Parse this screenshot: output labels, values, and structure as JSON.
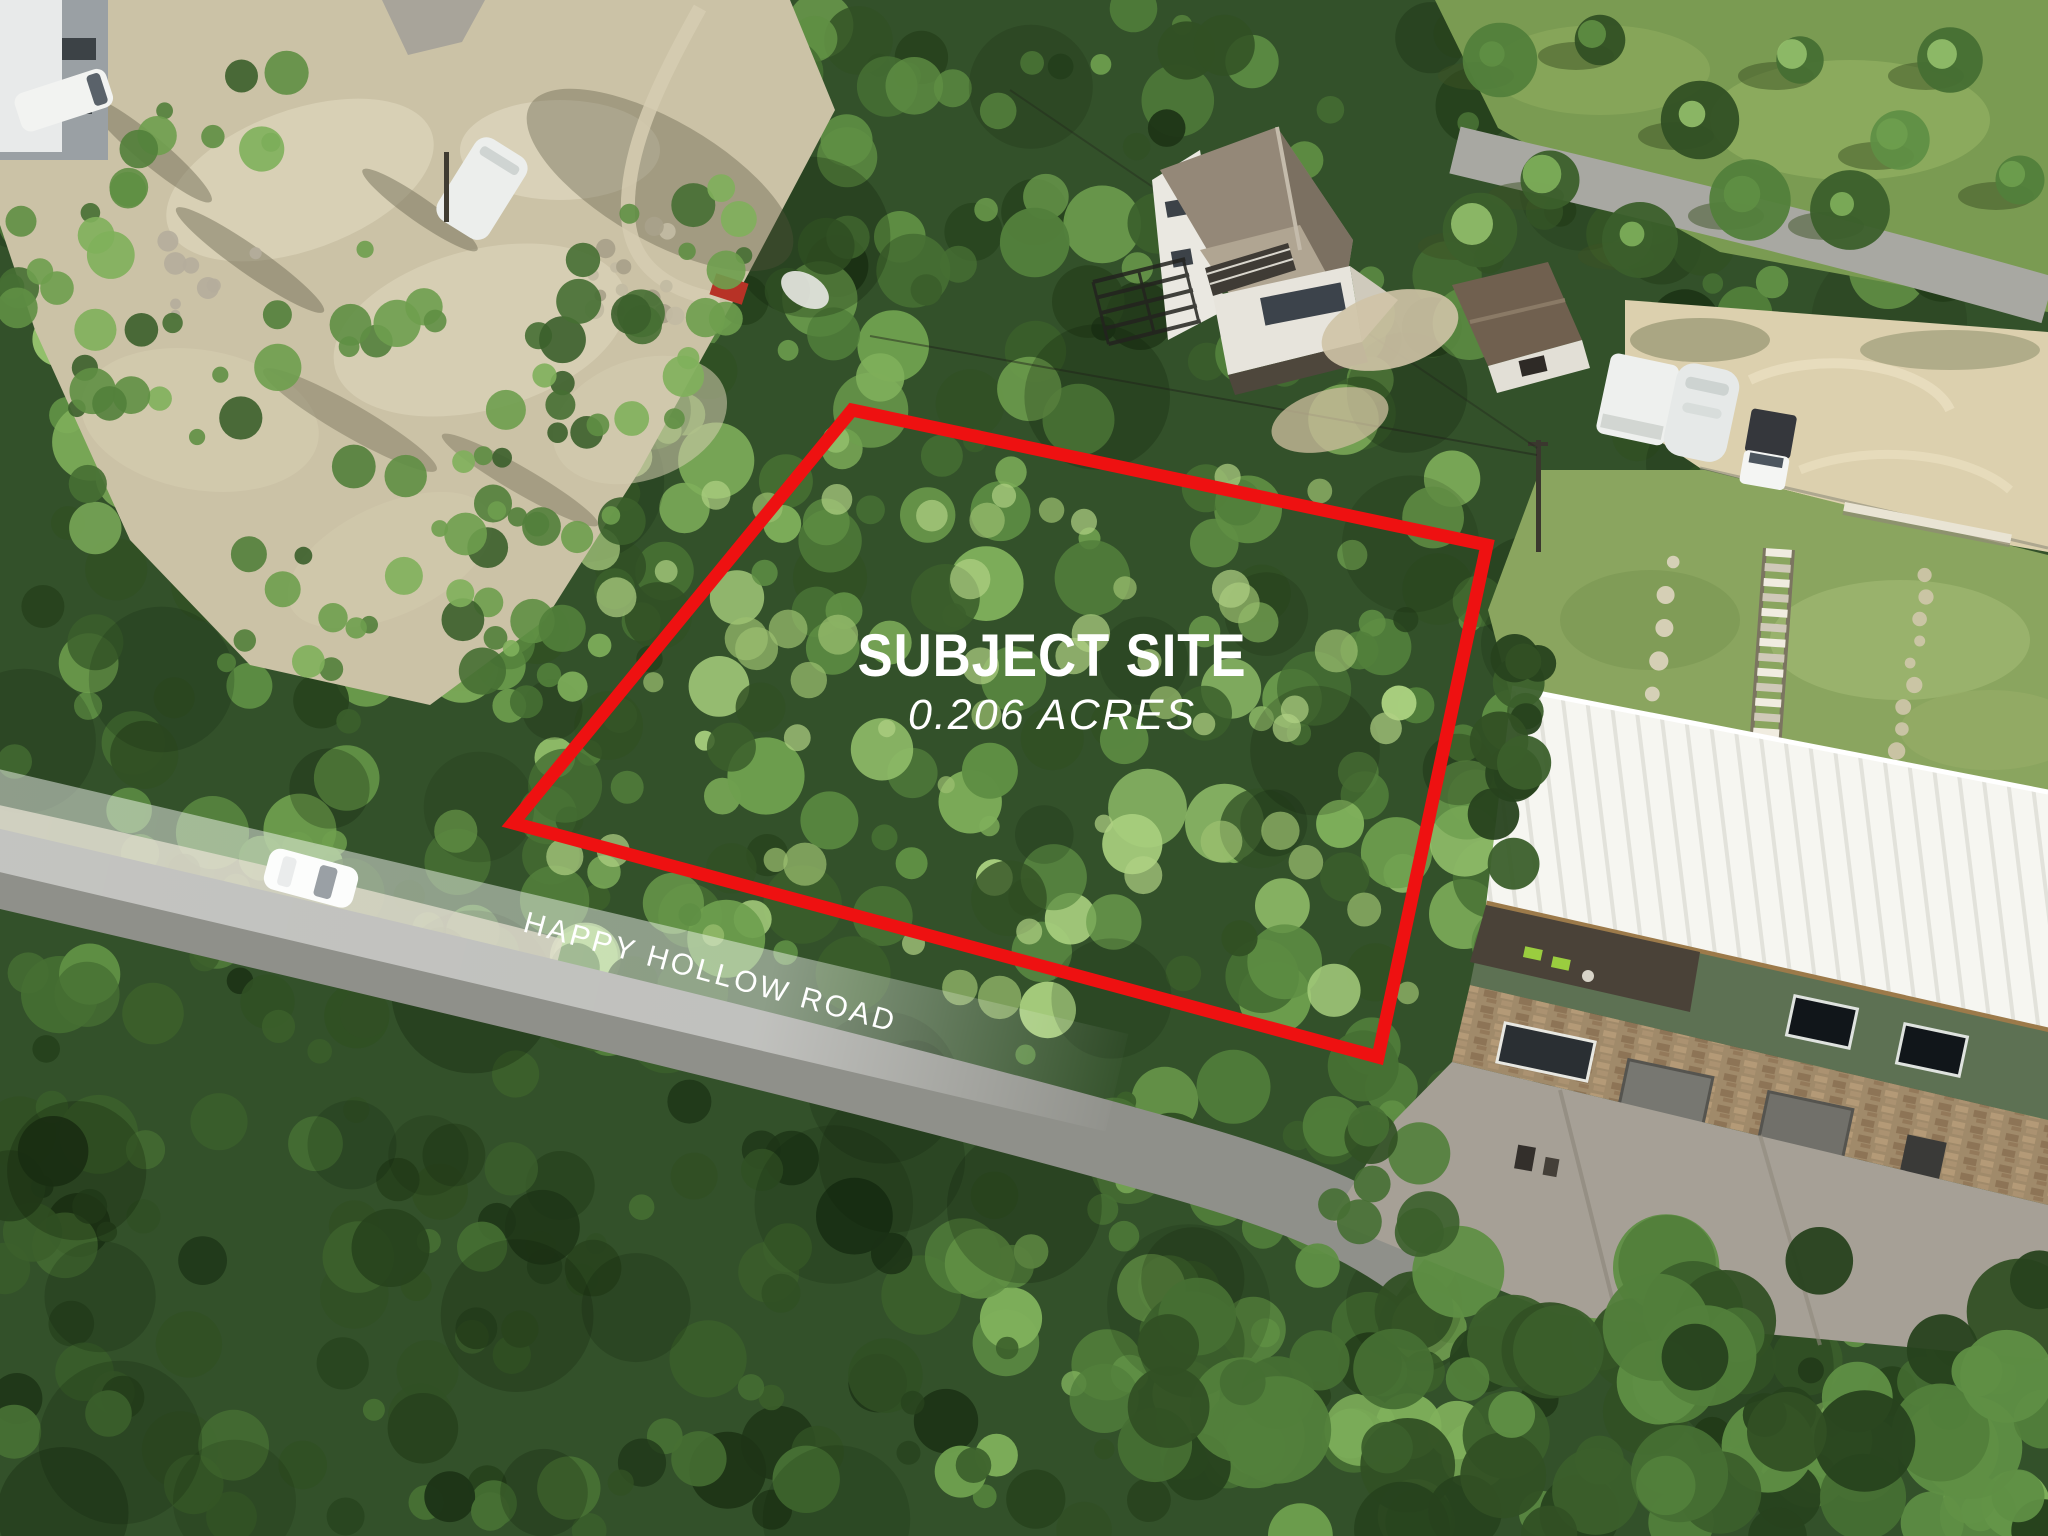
{
  "page": {
    "title": "Aerial property photo"
  },
  "annotations": {
    "site": {
      "title": "SUBJECT SITE",
      "subtitle": "0.206 ACRES",
      "text_color": "#ffffff"
    },
    "boundary": {
      "name": "subject-site-boundary",
      "stroke_color": "#ee1111",
      "stroke_width_px": 13,
      "vertices_px": [
        [
          852,
          410
        ],
        [
          1487,
          545
        ],
        [
          1378,
          1057
        ],
        [
          513,
          823
        ]
      ]
    },
    "road": {
      "label": "HAPPY HOLLOW ROAD",
      "text_color": "#ffffff",
      "angle_deg": 15.2,
      "banner_color": "rgba(255,255,255,0.45)"
    }
  }
}
